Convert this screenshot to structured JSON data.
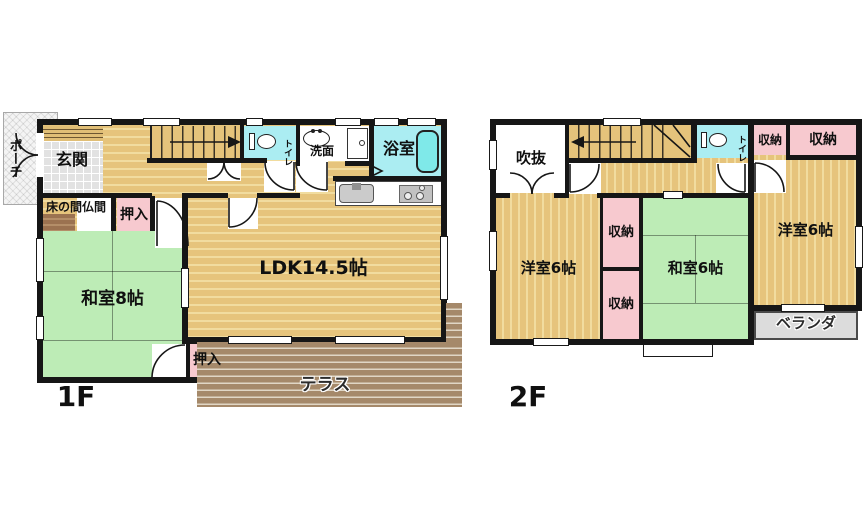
{
  "floor1": {
    "name": "1F",
    "porch": "ポーチ",
    "genkan": "玄関",
    "toilet": "トイレ",
    "senmen": "洗面",
    "bath": "浴室",
    "tokonoma": "床の間仏間",
    "oshiire_upper": "押入",
    "washitsu": "和室8帖",
    "ldk": "LDK14.5帖",
    "oshiire_lower": "押入",
    "terrace": "テラス"
  },
  "floor2": {
    "name": "2F",
    "fukinuke": "吹抜",
    "toilet": "トイレ",
    "closet_a": "収納",
    "closet_b": "収納",
    "closet_c": "収納",
    "closet_d": "収納",
    "yoshitsu_left": "洋室6帖",
    "washitsu": "和室6帖",
    "yoshitsu_right": "洋室6帖",
    "veranda": "ベランダ"
  },
  "colors": {
    "wood": "#e6c47c",
    "wood_stripe": "#f1dc9f",
    "tatami": "#bdecb6",
    "closet_pink": "#f7c9cf",
    "water_blue": "#abedf2",
    "terrace_brown": "#a5896a",
    "veranda_gray": "#dcdcdc",
    "entry_tile": "#e2e2e2",
    "tokonoma_brown": "#9b7250",
    "wall": "#161616"
  }
}
